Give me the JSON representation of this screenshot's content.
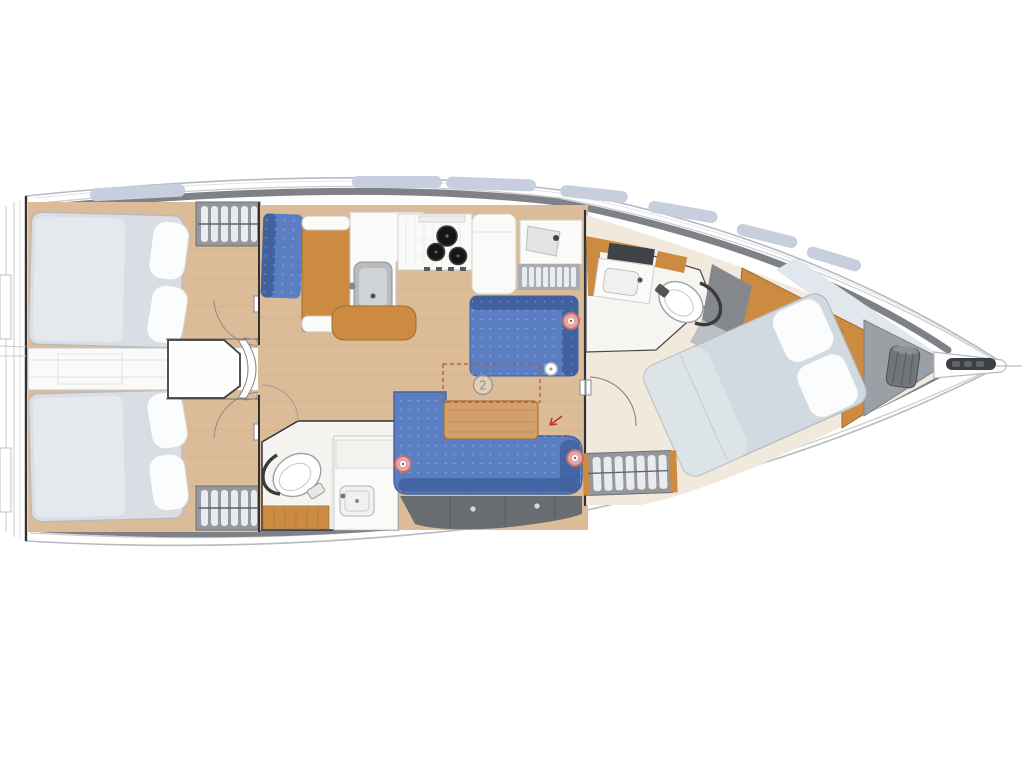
{
  "figure": {
    "type": "boat-floor-plan",
    "rooms": [
      "aft-cabin-port",
      "aft-cabin-starboard",
      "companionway-steps",
      "galley",
      "salon",
      "aft-head",
      "nav-area",
      "forward-head",
      "forward-cabin",
      "anchor-locker"
    ],
    "fixtures": [
      "double-berth",
      "pillows",
      "hanging-locker",
      "sink",
      "stove-3-burner",
      "refrigerator",
      "toilet",
      "vanity-basin",
      "settee-l-shaped",
      "saloon-table",
      "table-extension-dashed",
      "storage-lockers",
      "anchor-bag",
      "bowsprit"
    ]
  },
  "annotations": {
    "table_option_label": "2",
    "hatch_marker_count": 3
  },
  "colors": {
    "canvas_bg": "#ffffff",
    "hull_fill": "#ffffff",
    "hull_stroke": "#b7bac0",
    "deck_line": "#c9ccd1",
    "deck_band": "#7e8186",
    "window_glass": "#c7cede",
    "wood_floor": "#dcbc98",
    "wood_plank": "#c8a47c",
    "wood_furniture": "#cd8b41",
    "wood_furniture_dark": "#9c6d2e",
    "table_wood": "#d3a06b",
    "table_edge": "#a9732f",
    "upholstery": "#5b7ec2",
    "upholstery_dark": "#41619f",
    "mattress": "#d8dee3",
    "mattress_stroke": "#b4bac1",
    "duvet": "#d0dae0",
    "pillow": "#fbfcfd",
    "cream": "#f0e9dc",
    "white_fixture": "#fafaf8",
    "fixture_stroke": "#c9c7c3",
    "locker_dark": "#6a6d70",
    "cabinet_gray": "#94979b",
    "clothes": "#e9ebee",
    "pale_deck": "#e2e6ed",
    "anchor_gray": "#9aa0a5",
    "bag_gray": "#70757a",
    "bulkhead": "#2f3134",
    "marker_fill": "#e3a6a6",
    "marker_ring": "#bc6f6f",
    "knob_white": "#ffffff",
    "annotation_gray": "#8d939b",
    "arrow_red": "#c0392b",
    "dashed_red": "#b2543a",
    "toilet_dark": "#3a3a3a",
    "basin_gray": "#b8bcbe",
    "burner_black": "#161616"
  }
}
